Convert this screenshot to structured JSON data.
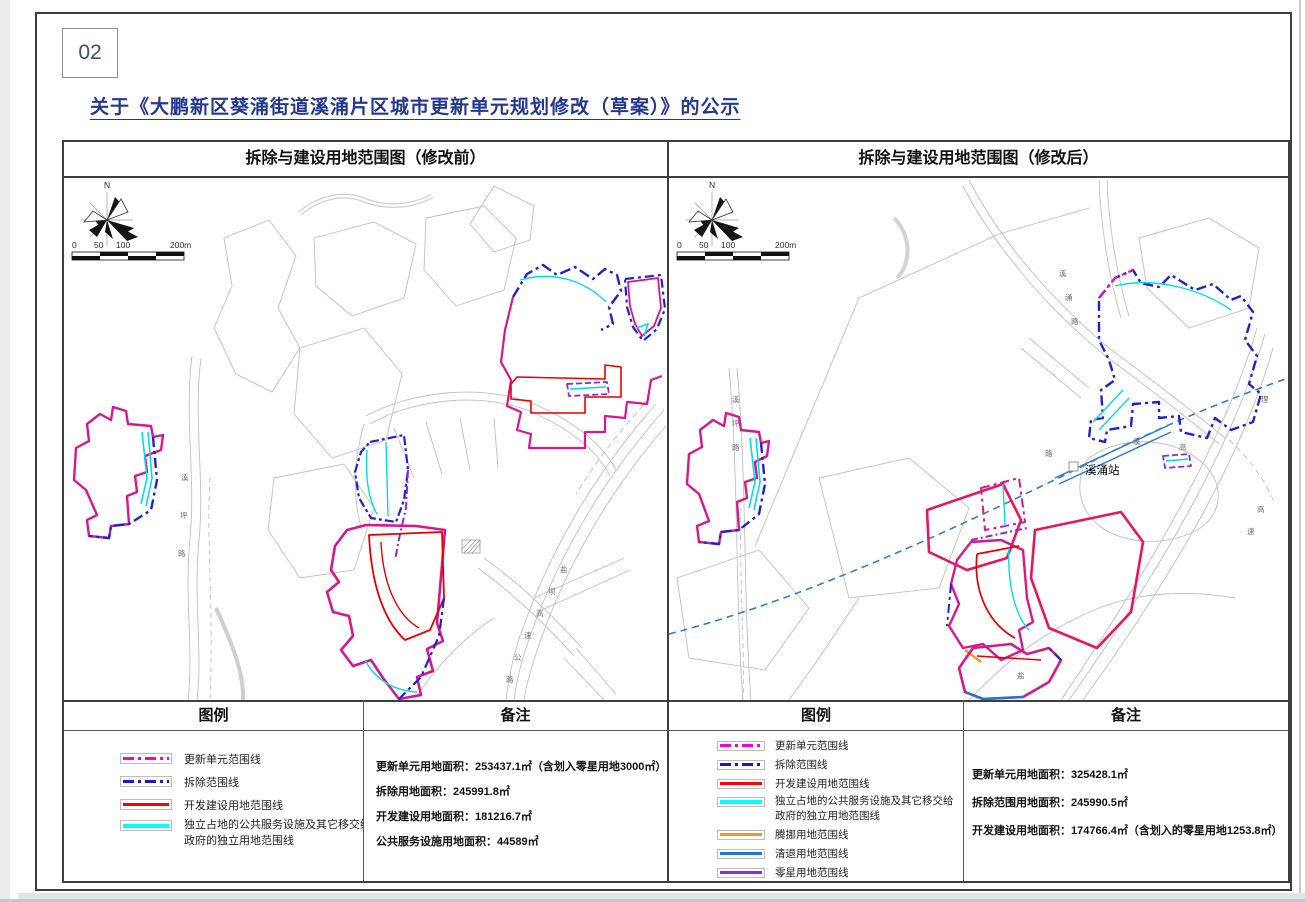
{
  "page": {
    "number": "02",
    "title": "关于《大鹏新区葵涌街道溪涌片区城市更新单元规划修改（草案）》的公示"
  },
  "colors": {
    "title_blue": "#24388f",
    "update_unit_line": "#ff00cc",
    "demolition_line": "#1a1acc",
    "development_line": "#ff0000",
    "public_facility_line": "#00ffff",
    "relocation_line": "#f7941d",
    "clearance_line": "#1e78d2",
    "scattered_line": "#8a2be2",
    "rail_line": "#2b7bd4"
  },
  "panels": [
    {
      "header": "拆除与建设用地范围图（修改前）",
      "legend_title": "图例",
      "notes_title": "备注",
      "legend": [
        {
          "label": "更新单元范围线",
          "color": "#ff00cc"
        },
        {
          "label": "拆除范围线",
          "color": "#1a1acc"
        },
        {
          "label": "开发建设用地范围线",
          "color": "#ff0000"
        },
        {
          "label": "独立占地的公共服务设施及其它移交给",
          "label2": "政府的独立用地范围线",
          "color": "#00ffff"
        }
      ],
      "notes": [
        "更新单元用地面积：253437.1㎡（含划入零星用地3000㎡）",
        "拆除用地面积：245991.8㎡",
        "开发建设用地面积：181216.7㎡",
        "公共服务设施用地面积：44589㎡"
      ]
    },
    {
      "header": "拆除与建设用地范围图（修改后）",
      "legend_title": "图例",
      "notes_title": "备注",
      "legend": [
        {
          "label": "更新单元范围线",
          "color": "#ff00cc"
        },
        {
          "label": "拆除范围线",
          "color": "#1a1acc"
        },
        {
          "label": "开发建设用地范围线",
          "color": "#ff0000"
        },
        {
          "label": "独立占地的公共服务设施及其它移交给",
          "label2": "政府的独立用地范围线",
          "color": "#00ffff"
        },
        {
          "label": "腾挪用地范围线",
          "color": "#f7941d"
        },
        {
          "label": "清退用地范围线",
          "color": "#1e78d2"
        },
        {
          "label": "零星用地范围线",
          "color": "#8a2be2"
        },
        {
          "label": "轨道线及站点-近中期",
          "color": "#2b7bd4"
        }
      ],
      "notes": [
        "更新单元用地面积：325428.1㎡",
        "拆除范围用地面积：245990.5㎡",
        "开发建设用地面积：174766.4㎡（含划入的零星用地1253.8㎡）"
      ]
    }
  ],
  "map": {
    "north": "N",
    "scale_ticks": [
      "0",
      "50",
      "100",
      "200m"
    ],
    "left_labels": {
      "v_road": [
        "溪",
        "坪",
        "路"
      ],
      "expressway": [
        "盐",
        "坝",
        "高",
        "速",
        "公",
        "路"
      ]
    },
    "right_labels": {
      "v_road": [
        "溪",
        "坪",
        "路"
      ],
      "top_road": [
        "溪",
        "涌",
        "路"
      ],
      "station": "溪涌站",
      "near_station": [
        "溪",
        "高",
        "路"
      ],
      "bottom": "盐",
      "right_edge": "理",
      "expressway": [
        "高",
        "速"
      ]
    }
  }
}
